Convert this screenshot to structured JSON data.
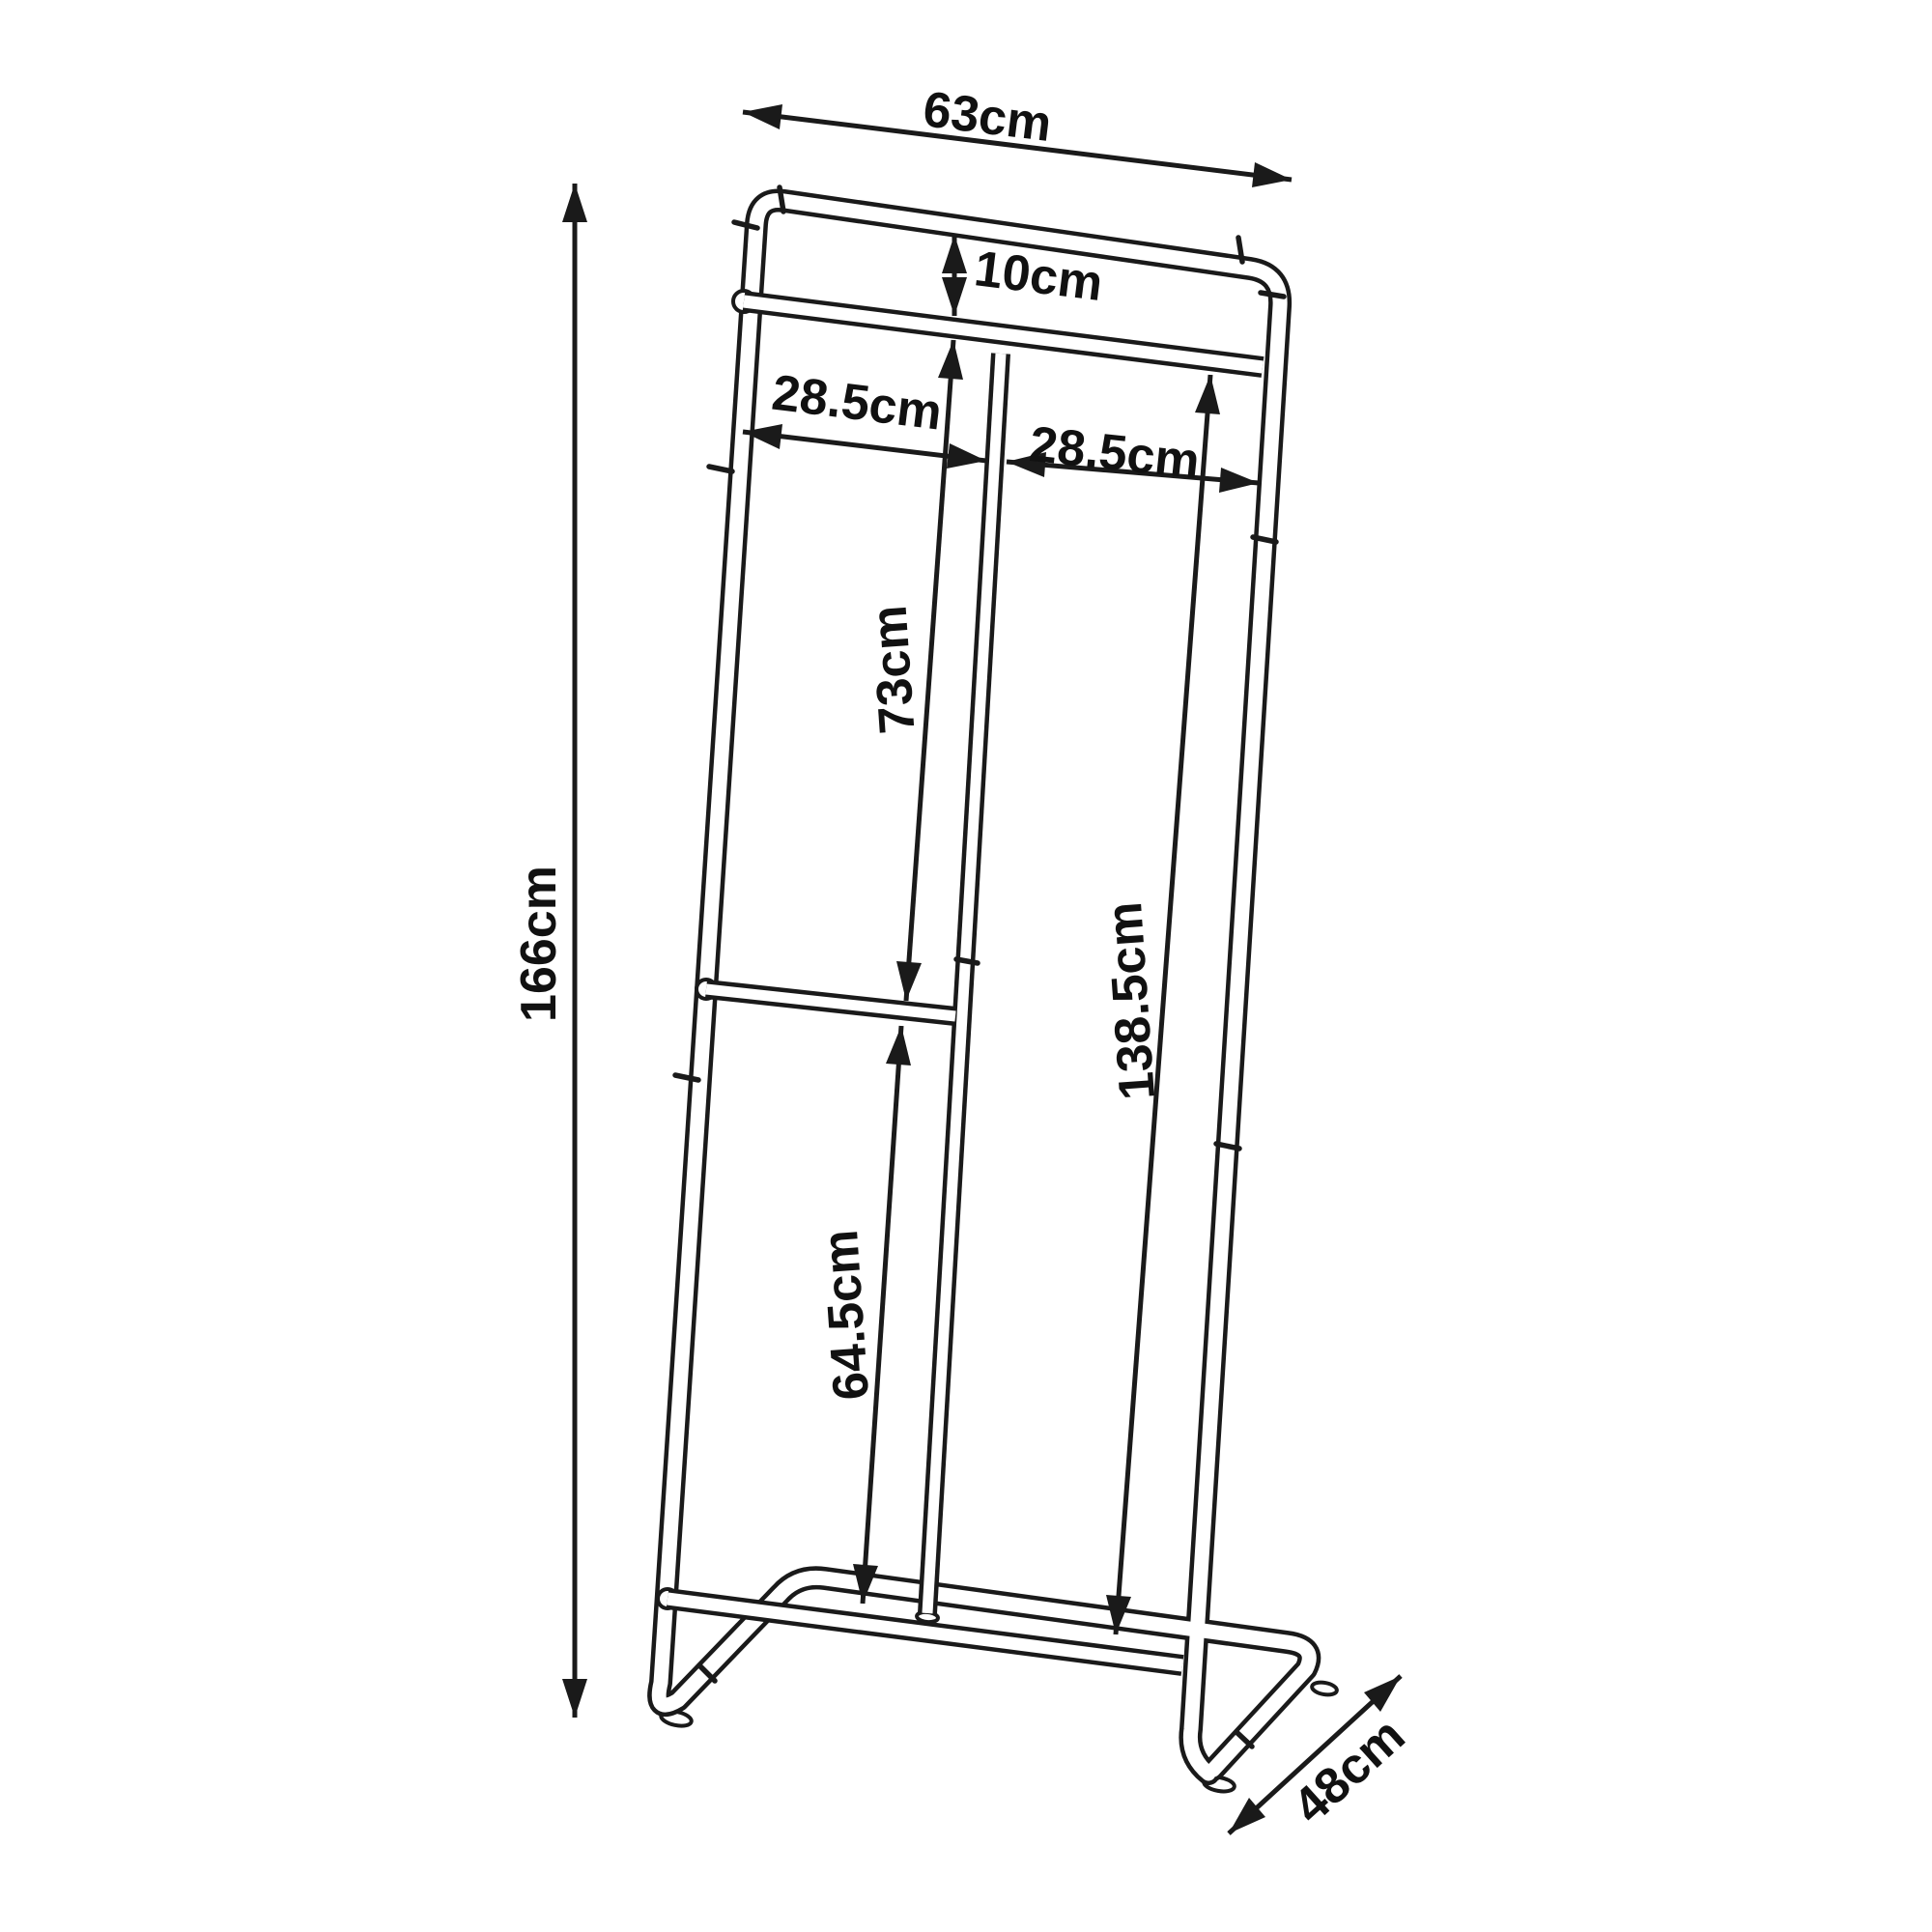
{
  "page": {
    "background": "#ffffff"
  },
  "drawing": {
    "line_color": "#1a1a1a",
    "label_color": "#111111",
    "subject": "clothes-rack-dimension-diagram",
    "dimensions": {
      "top_width": "63cm",
      "top_bar_gap": "10cm",
      "left_section": "28.5cm",
      "right_section": "28.5cm",
      "middle_section": "73cm",
      "lower_section": "64.5cm",
      "hanging_height": "138.5cm",
      "total_height": "166cm",
      "base_depth": "48cm"
    }
  }
}
